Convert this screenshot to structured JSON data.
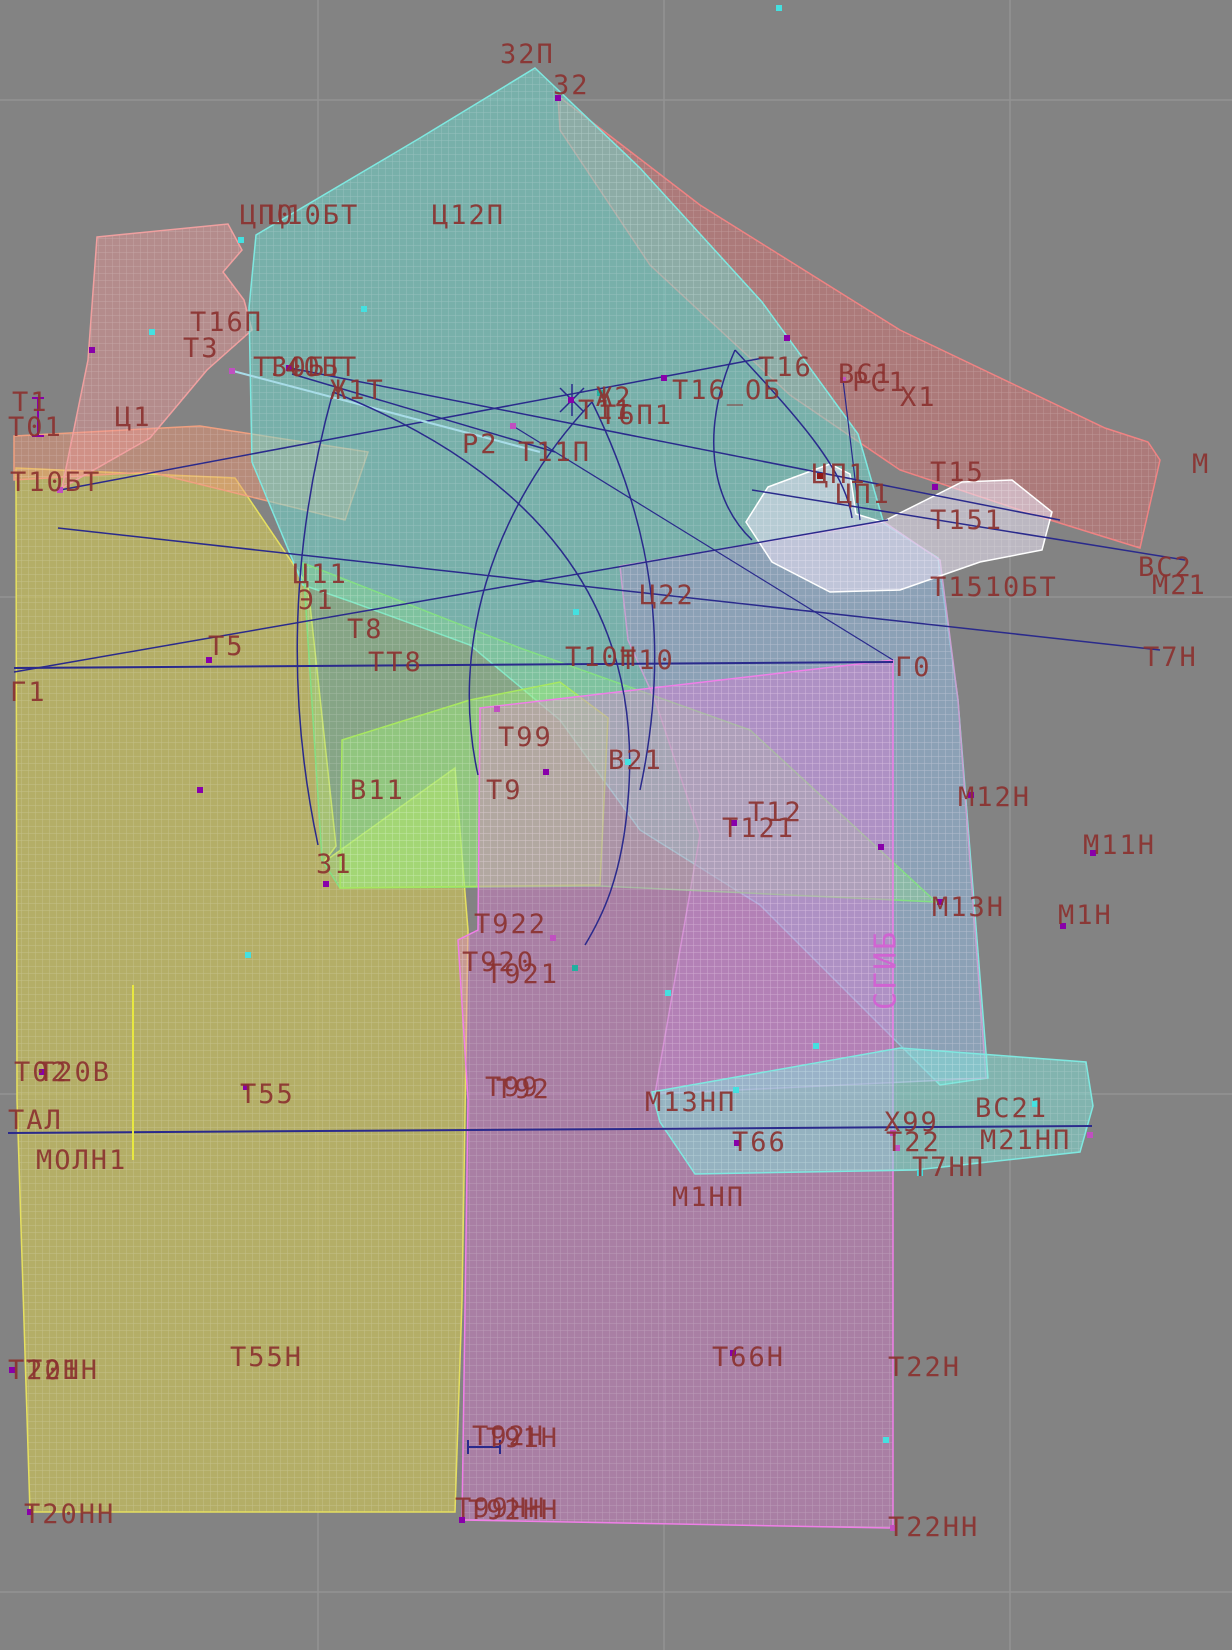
{
  "app": {
    "type": "garment-pattern-cad-canvas"
  },
  "canvas": {
    "width": 1232,
    "height": 1650,
    "bg": "#838383"
  },
  "grid": {
    "color": "#939393",
    "vlines": [
      318,
      664,
      1010
    ],
    "hlines": [
      100,
      597,
      1094,
      1592
    ]
  },
  "label_style": {
    "color": "#8b3230",
    "size": 27,
    "fold_color": "#d35fd3"
  },
  "pieces": [
    {
      "name": "piece-yellow-left-panel",
      "fill": "rgba(220,210,80,0.55)",
      "stroke": "#e6e060",
      "points": "16,468 235,478 308,586 336,846 324,862 455,768 468,930 462,1300 455,1512 30,1512 17,1100"
    },
    {
      "name": "piece-salmon-left-top",
      "fill": "rgba(235,150,115,0.5)",
      "stroke": "#f0a080",
      "points": "14,436 200,426 368,452 345,520 150,472 14,480"
    },
    {
      "name": "piece-pink-shoulder",
      "fill": "rgba(240,150,150,0.45)",
      "stroke": "#f0a0a0",
      "points": "97,237 228,224 242,250 223,272 244,300 252,330 207,370 150,438 62,488 88,360"
    },
    {
      "name": "piece-red-sleeve-band",
      "fill": "rgba(235,110,110,0.4)",
      "stroke": "#ef8383",
      "points": "558,96 700,205 900,330 1105,428 1148,442 1160,460 1140,548 1050,520 900,470 790,395 650,265 560,130"
    },
    {
      "name": "piece-teal-main",
      "fill": "rgba(110,222,210,0.5)",
      "stroke": "#7fe8e0",
      "points": "535,68 640,168 762,302 858,434 884,524 938,558 958,700 988,1078 940,1085 760,905 640,830 560,720 470,645 352,602 303,585 252,462 249,308 256,235 420,138"
    },
    {
      "name": "piece-plum-right",
      "fill": "rgba(170,140,200,0.42)",
      "stroke": "#c8a0d0",
      "points": "620,566 884,522 940,560 958,700 986,1078 655,1094 700,835 655,700 628,640"
    },
    {
      "name": "piece-green-band",
      "fill": "rgba(140,230,140,0.35)",
      "stroke": "#84df84",
      "points": "303,563 520,648 750,730 936,902 600,886 340,888 322,860"
    },
    {
      "name": "piece-green-side-quad",
      "fill": "rgba(160,240,120,0.45)",
      "stroke": "#a8e860",
      "points": "342,740 470,700 560,682 608,718 600,885 340,888"
    },
    {
      "name": "piece-magenta-skirt",
      "fill": "rgba(232,120,218,0.38)",
      "stroke": "#f07fe8",
      "points": "480,708 893,660 893,1528 462,1520 468,1100 458,940 478,930"
    },
    {
      "name": "piece-cyan-bottom",
      "fill": "rgba(130,230,220,0.5)",
      "stroke": "#7fe8e0",
      "points": "652,1092 900,1048 1086,1062 1093,1106 1080,1152 915,1170 695,1174 660,1122"
    },
    {
      "name": "piece-collar-white",
      "fill": "rgba(235,228,245,0.55)",
      "stroke": "#ffffff",
      "points": "768,487 830,464 850,474 856,514 882,522 962,482 1012,480 1052,512 1042,550 980,562 900,590 830,592 772,562 746,522"
    }
  ],
  "lines": [
    {
      "x1": 14,
      "y1": 668,
      "x2": 893,
      "y2": 662,
      "c": "#2a2a8c",
      "w": 2
    },
    {
      "x1": 8,
      "y1": 1133,
      "x2": 1092,
      "y2": 1126,
      "c": "#2a2a8c",
      "w": 2
    },
    {
      "x1": 58,
      "y1": 528,
      "x2": 1160,
      "y2": 650,
      "c": "#2a2a8c",
      "w": 1.5
    },
    {
      "x1": 14,
      "y1": 672,
      "x2": 888,
      "y2": 520,
      "c": "#2a2a8c",
      "w": 1.5
    },
    {
      "x1": 290,
      "y1": 368,
      "x2": 1060,
      "y2": 520,
      "c": "#2a2a8c",
      "w": 1.5
    },
    {
      "x1": 292,
      "y1": 374,
      "x2": 555,
      "y2": 452,
      "c": "#2a2a8c",
      "w": 1.5
    },
    {
      "x1": 60,
      "y1": 490,
      "x2": 763,
      "y2": 358,
      "c": "#2a2a8c",
      "w": 1.5
    },
    {
      "x1": 513,
      "y1": 426,
      "x2": 893,
      "y2": 660,
      "c": "#2a2a8c",
      "w": 1.2
    },
    {
      "x1": 752,
      "y1": 490,
      "x2": 1185,
      "y2": 560,
      "c": "#2a2a8c",
      "w": 1.5
    },
    {
      "x1": 843,
      "y1": 380,
      "x2": 860,
      "y2": 520,
      "c": "#2a2a8c",
      "w": 1.2
    },
    {
      "x1": 233,
      "y1": 371,
      "x2": 540,
      "y2": 452,
      "c": "#a8dce8",
      "w": 2
    },
    {
      "x1": 133,
      "y1": 985,
      "x2": 133,
      "y2": 1160,
      "c": "#e8e840",
      "w": 2
    },
    {
      "x1": 38,
      "y1": 398,
      "x2": 38,
      "y2": 436,
      "c": "#8800aa",
      "w": 2
    },
    {
      "x1": 32,
      "y1": 398,
      "x2": 44,
      "y2": 398,
      "c": "#8800aa",
      "w": 2
    },
    {
      "x1": 32,
      "y1": 436,
      "x2": 44,
      "y2": 436,
      "c": "#8800aa",
      "w": 2
    },
    {
      "x1": 468,
      "y1": 1447,
      "x2": 500,
      "y2": 1447,
      "c": "#2a2a8c",
      "w": 2
    },
    {
      "x1": 468,
      "y1": 1440,
      "x2": 468,
      "y2": 1454,
      "c": "#2a2a8c",
      "w": 2
    },
    {
      "x1": 500,
      "y1": 1440,
      "x2": 500,
      "y2": 1454,
      "c": "#2a2a8c",
      "w": 2
    },
    {
      "x1": 560,
      "y1": 388,
      "x2": 584,
      "y2": 412,
      "c": "#2a2a8c",
      "w": 1.5
    },
    {
      "x1": 560,
      "y1": 412,
      "x2": 584,
      "y2": 388,
      "c": "#2a2a8c",
      "w": 1.5
    },
    {
      "x1": 572,
      "y1": 384,
      "x2": 572,
      "y2": 416,
      "c": "#2a2a8c",
      "w": 1.5
    }
  ],
  "curves": [
    {
      "d": "M 333 392 Q 270 620 318 845",
      "c": "#2a2a8c"
    },
    {
      "d": "M 333 392 C 530 470 645 600 628 800 C 622 880 600 920 585 945",
      "c": "#2a2a8c"
    },
    {
      "d": "M 592 402 C 490 510 450 650 478 775",
      "c": "#2a2a8c"
    },
    {
      "d": "M 592 402 C 650 520 672 640 640 790",
      "c": "#2a2a8c"
    },
    {
      "d": "M 735 350 C 700 430 710 500 752 540",
      "c": "#2a2a8c"
    },
    {
      "d": "M 735 350 C 800 420 845 470 852 518",
      "c": "#2a2a8c"
    }
  ],
  "labels": [
    {
      "t": "32П",
      "x": 500,
      "y": 42
    },
    {
      "t": "32",
      "x": 553,
      "y": 73
    },
    {
      "t": "ЦП0",
      "x": 240,
      "y": 203
    },
    {
      "t": "Ц10БТ",
      "x": 268,
      "y": 203
    },
    {
      "t": "Ц12П",
      "x": 432,
      "y": 203
    },
    {
      "t": "Т16П",
      "x": 190,
      "y": 310
    },
    {
      "t": "Т3",
      "x": 183,
      "y": 336
    },
    {
      "t": "Т30БТ",
      "x": 253,
      "y": 355
    },
    {
      "t": "Т40БТ",
      "x": 267,
      "y": 355
    },
    {
      "t": "Ж1Т",
      "x": 330,
      "y": 378
    },
    {
      "t": "Т1",
      "x": 12,
      "y": 390
    },
    {
      "t": "Т01",
      "x": 8,
      "y": 415
    },
    {
      "t": "Ц1",
      "x": 115,
      "y": 405
    },
    {
      "t": "Т10БТ",
      "x": 10,
      "y": 470
    },
    {
      "t": "Р2",
      "x": 462,
      "y": 432
    },
    {
      "t": "Т11П",
      "x": 518,
      "y": 440
    },
    {
      "t": "Ж2",
      "x": 596,
      "y": 385
    },
    {
      "t": "Т11",
      "x": 578,
      "y": 398
    },
    {
      "t": "Т6П1",
      "x": 600,
      "y": 403
    },
    {
      "t": "Т16",
      "x": 758,
      "y": 355
    },
    {
      "t": "Т16_ОБ",
      "x": 672,
      "y": 378
    },
    {
      "t": "ВС1",
      "x": 838,
      "y": 362
    },
    {
      "t": "РС1",
      "x": 852,
      "y": 370
    },
    {
      "t": "Х1",
      "x": 900,
      "y": 385
    },
    {
      "t": "М",
      "x": 1192,
      "y": 452
    },
    {
      "t": "ЦП1",
      "x": 812,
      "y": 462
    },
    {
      "t": "ЦП1",
      "x": 836,
      "y": 482
    },
    {
      "t": "Т15",
      "x": 930,
      "y": 460
    },
    {
      "t": "Т151",
      "x": 930,
      "y": 508
    },
    {
      "t": "Т1510БТ",
      "x": 930,
      "y": 575
    },
    {
      "t": "ВС2",
      "x": 1138,
      "y": 555
    },
    {
      "t": "М21",
      "x": 1152,
      "y": 573
    },
    {
      "t": "Ц11",
      "x": 293,
      "y": 562
    },
    {
      "t": "Э1",
      "x": 298,
      "y": 588
    },
    {
      "t": "Т8",
      "x": 347,
      "y": 617
    },
    {
      "t": "ТТ8",
      "x": 368,
      "y": 650
    },
    {
      "t": "Т5",
      "x": 208,
      "y": 634
    },
    {
      "t": "Г1",
      "x": 10,
      "y": 680
    },
    {
      "t": "Ц22",
      "x": 640,
      "y": 583
    },
    {
      "t": "Т10Н",
      "x": 565,
      "y": 645
    },
    {
      "t": "Т10",
      "x": 620,
      "y": 648
    },
    {
      "t": "Г0",
      "x": 895,
      "y": 655
    },
    {
      "t": "Т7Н",
      "x": 1143,
      "y": 645
    },
    {
      "t": "Т99",
      "x": 498,
      "y": 725
    },
    {
      "t": "В21",
      "x": 608,
      "y": 748
    },
    {
      "t": "В11",
      "x": 350,
      "y": 778
    },
    {
      "t": "Т9",
      "x": 486,
      "y": 778
    },
    {
      "t": "Т12",
      "x": 748,
      "y": 800
    },
    {
      "t": "Т121",
      "x": 722,
      "y": 816
    },
    {
      "t": "М12Н",
      "x": 958,
      "y": 785
    },
    {
      "t": "М11Н",
      "x": 1083,
      "y": 833
    },
    {
      "t": "З1",
      "x": 316,
      "y": 852
    },
    {
      "t": "М13Н",
      "x": 932,
      "y": 895
    },
    {
      "t": "М1Н",
      "x": 1058,
      "y": 903
    },
    {
      "t": "Т922",
      "x": 474,
      "y": 912
    },
    {
      "t": "Т920",
      "x": 462,
      "y": 950
    },
    {
      "t": "Т921",
      "x": 486,
      "y": 962
    },
    {
      "t": "Т02",
      "x": 14,
      "y": 1060
    },
    {
      "t": "Т20В",
      "x": 38,
      "y": 1060
    },
    {
      "t": "Т55",
      "x": 240,
      "y": 1082
    },
    {
      "t": "Т99",
      "x": 485,
      "y": 1075
    },
    {
      "t": "Т92",
      "x": 496,
      "y": 1077
    },
    {
      "t": "ТАЛ",
      "x": 8,
      "y": 1108
    },
    {
      "t": "МОЛН1",
      "x": 36,
      "y": 1148
    },
    {
      "t": "М13НП",
      "x": 645,
      "y": 1090
    },
    {
      "t": "Т66",
      "x": 732,
      "y": 1130
    },
    {
      "t": "Х99",
      "x": 884,
      "y": 1110
    },
    {
      "t": "Т22",
      "x": 886,
      "y": 1130
    },
    {
      "t": "ВС21",
      "x": 975,
      "y": 1096
    },
    {
      "t": "М21НП",
      "x": 980,
      "y": 1128
    },
    {
      "t": "Т7НП",
      "x": 912,
      "y": 1155
    },
    {
      "t": "М1НП",
      "x": 672,
      "y": 1185
    },
    {
      "t": "Т55Н",
      "x": 230,
      "y": 1345
    },
    {
      "t": "Т20Н",
      "x": 8,
      "y": 1358
    },
    {
      "t": "Т21Н",
      "x": 26,
      "y": 1358
    },
    {
      "t": "Т92Н",
      "x": 472,
      "y": 1424
    },
    {
      "t": "Т91Н",
      "x": 486,
      "y": 1426
    },
    {
      "t": "Т66Н",
      "x": 712,
      "y": 1345
    },
    {
      "t": "Т22Н",
      "x": 888,
      "y": 1355
    },
    {
      "t": "Т20НН",
      "x": 24,
      "y": 1502
    },
    {
      "t": "Т99НН",
      "x": 455,
      "y": 1496
    },
    {
      "t": "Т92НН",
      "x": 468,
      "y": 1498
    },
    {
      "t": "Т22НН",
      "x": 888,
      "y": 1515
    },
    {
      "t": "СГИБ",
      "x": 872,
      "y": 1010,
      "rotate": -90,
      "color": "#d35fd3",
      "size": 30
    }
  ],
  "markers": [
    {
      "x": 558,
      "y": 98,
      "c": "#8800aa"
    },
    {
      "x": 241,
      "y": 240,
      "c": "#44e0e0"
    },
    {
      "x": 152,
      "y": 332,
      "c": "#44e0e0"
    },
    {
      "x": 364,
      "y": 309,
      "c": "#44e0e0"
    },
    {
      "x": 92,
      "y": 350,
      "c": "#8800aa"
    },
    {
      "x": 60,
      "y": 490,
      "c": "#c050c0"
    },
    {
      "x": 232,
      "y": 371,
      "c": "#c050c0"
    },
    {
      "x": 289,
      "y": 368,
      "c": "#8800aa"
    },
    {
      "x": 513,
      "y": 426,
      "c": "#c050c0"
    },
    {
      "x": 571,
      "y": 400,
      "c": "#8800aa"
    },
    {
      "x": 600,
      "y": 393,
      "c": "#20b0a0"
    },
    {
      "x": 664,
      "y": 378,
      "c": "#8800aa"
    },
    {
      "x": 787,
      "y": 338,
      "c": "#8800aa"
    },
    {
      "x": 843,
      "y": 380,
      "c": "#c050c0"
    },
    {
      "x": 935,
      "y": 487,
      "c": "#8800aa"
    },
    {
      "x": 820,
      "y": 476,
      "c": "#901818"
    },
    {
      "x": 209,
      "y": 660,
      "c": "#8800aa"
    },
    {
      "x": 576,
      "y": 612,
      "c": "#44e0e0"
    },
    {
      "x": 200,
      "y": 790,
      "c": "#8800aa"
    },
    {
      "x": 326,
      "y": 884,
      "c": "#8800aa"
    },
    {
      "x": 497,
      "y": 709,
      "c": "#c050c0"
    },
    {
      "x": 546,
      "y": 772,
      "c": "#8800aa"
    },
    {
      "x": 734,
      "y": 823,
      "c": "#8800aa"
    },
    {
      "x": 881,
      "y": 847,
      "c": "#8800aa"
    },
    {
      "x": 940,
      "y": 902,
      "c": "#8800aa"
    },
    {
      "x": 1093,
      "y": 853,
      "c": "#8800aa"
    },
    {
      "x": 1063,
      "y": 926,
      "c": "#8800aa"
    },
    {
      "x": 971,
      "y": 795,
      "c": "#8800aa"
    },
    {
      "x": 553,
      "y": 938,
      "c": "#c050c0"
    },
    {
      "x": 575,
      "y": 968,
      "c": "#20b0a0"
    },
    {
      "x": 248,
      "y": 955,
      "c": "#44e0e0"
    },
    {
      "x": 668,
      "y": 993,
      "c": "#44e0e0"
    },
    {
      "x": 779,
      "y": 8,
      "c": "#44e0e0"
    },
    {
      "x": 816,
      "y": 1046,
      "c": "#44e0e0"
    },
    {
      "x": 42,
      "y": 1072,
      "c": "#8800aa"
    },
    {
      "x": 736,
      "y": 1090,
      "c": "#44e0e0"
    },
    {
      "x": 737,
      "y": 1143,
      "c": "#8800aa"
    },
    {
      "x": 893,
      "y": 1133,
      "c": "#c050c0"
    },
    {
      "x": 897,
      "y": 1148,
      "c": "#c050c0"
    },
    {
      "x": 1035,
      "y": 1104,
      "c": "#44e0e0"
    },
    {
      "x": 1090,
      "y": 1135,
      "c": "#c050c0"
    },
    {
      "x": 920,
      "y": 1173,
      "c": "#44e0e0"
    },
    {
      "x": 733,
      "y": 1353,
      "c": "#8800aa"
    },
    {
      "x": 886,
      "y": 1440,
      "c": "#44e0e0"
    },
    {
      "x": 12,
      "y": 1370,
      "c": "#8800aa"
    },
    {
      "x": 30,
      "y": 1512,
      "c": "#8800aa"
    },
    {
      "x": 462,
      "y": 1520,
      "c": "#8800aa"
    },
    {
      "x": 893,
      "y": 1528,
      "c": "#c050c0"
    },
    {
      "x": 246,
      "y": 1087,
      "c": "#8800aa"
    },
    {
      "x": 628,
      "y": 762,
      "c": "#44e0e0"
    }
  ]
}
